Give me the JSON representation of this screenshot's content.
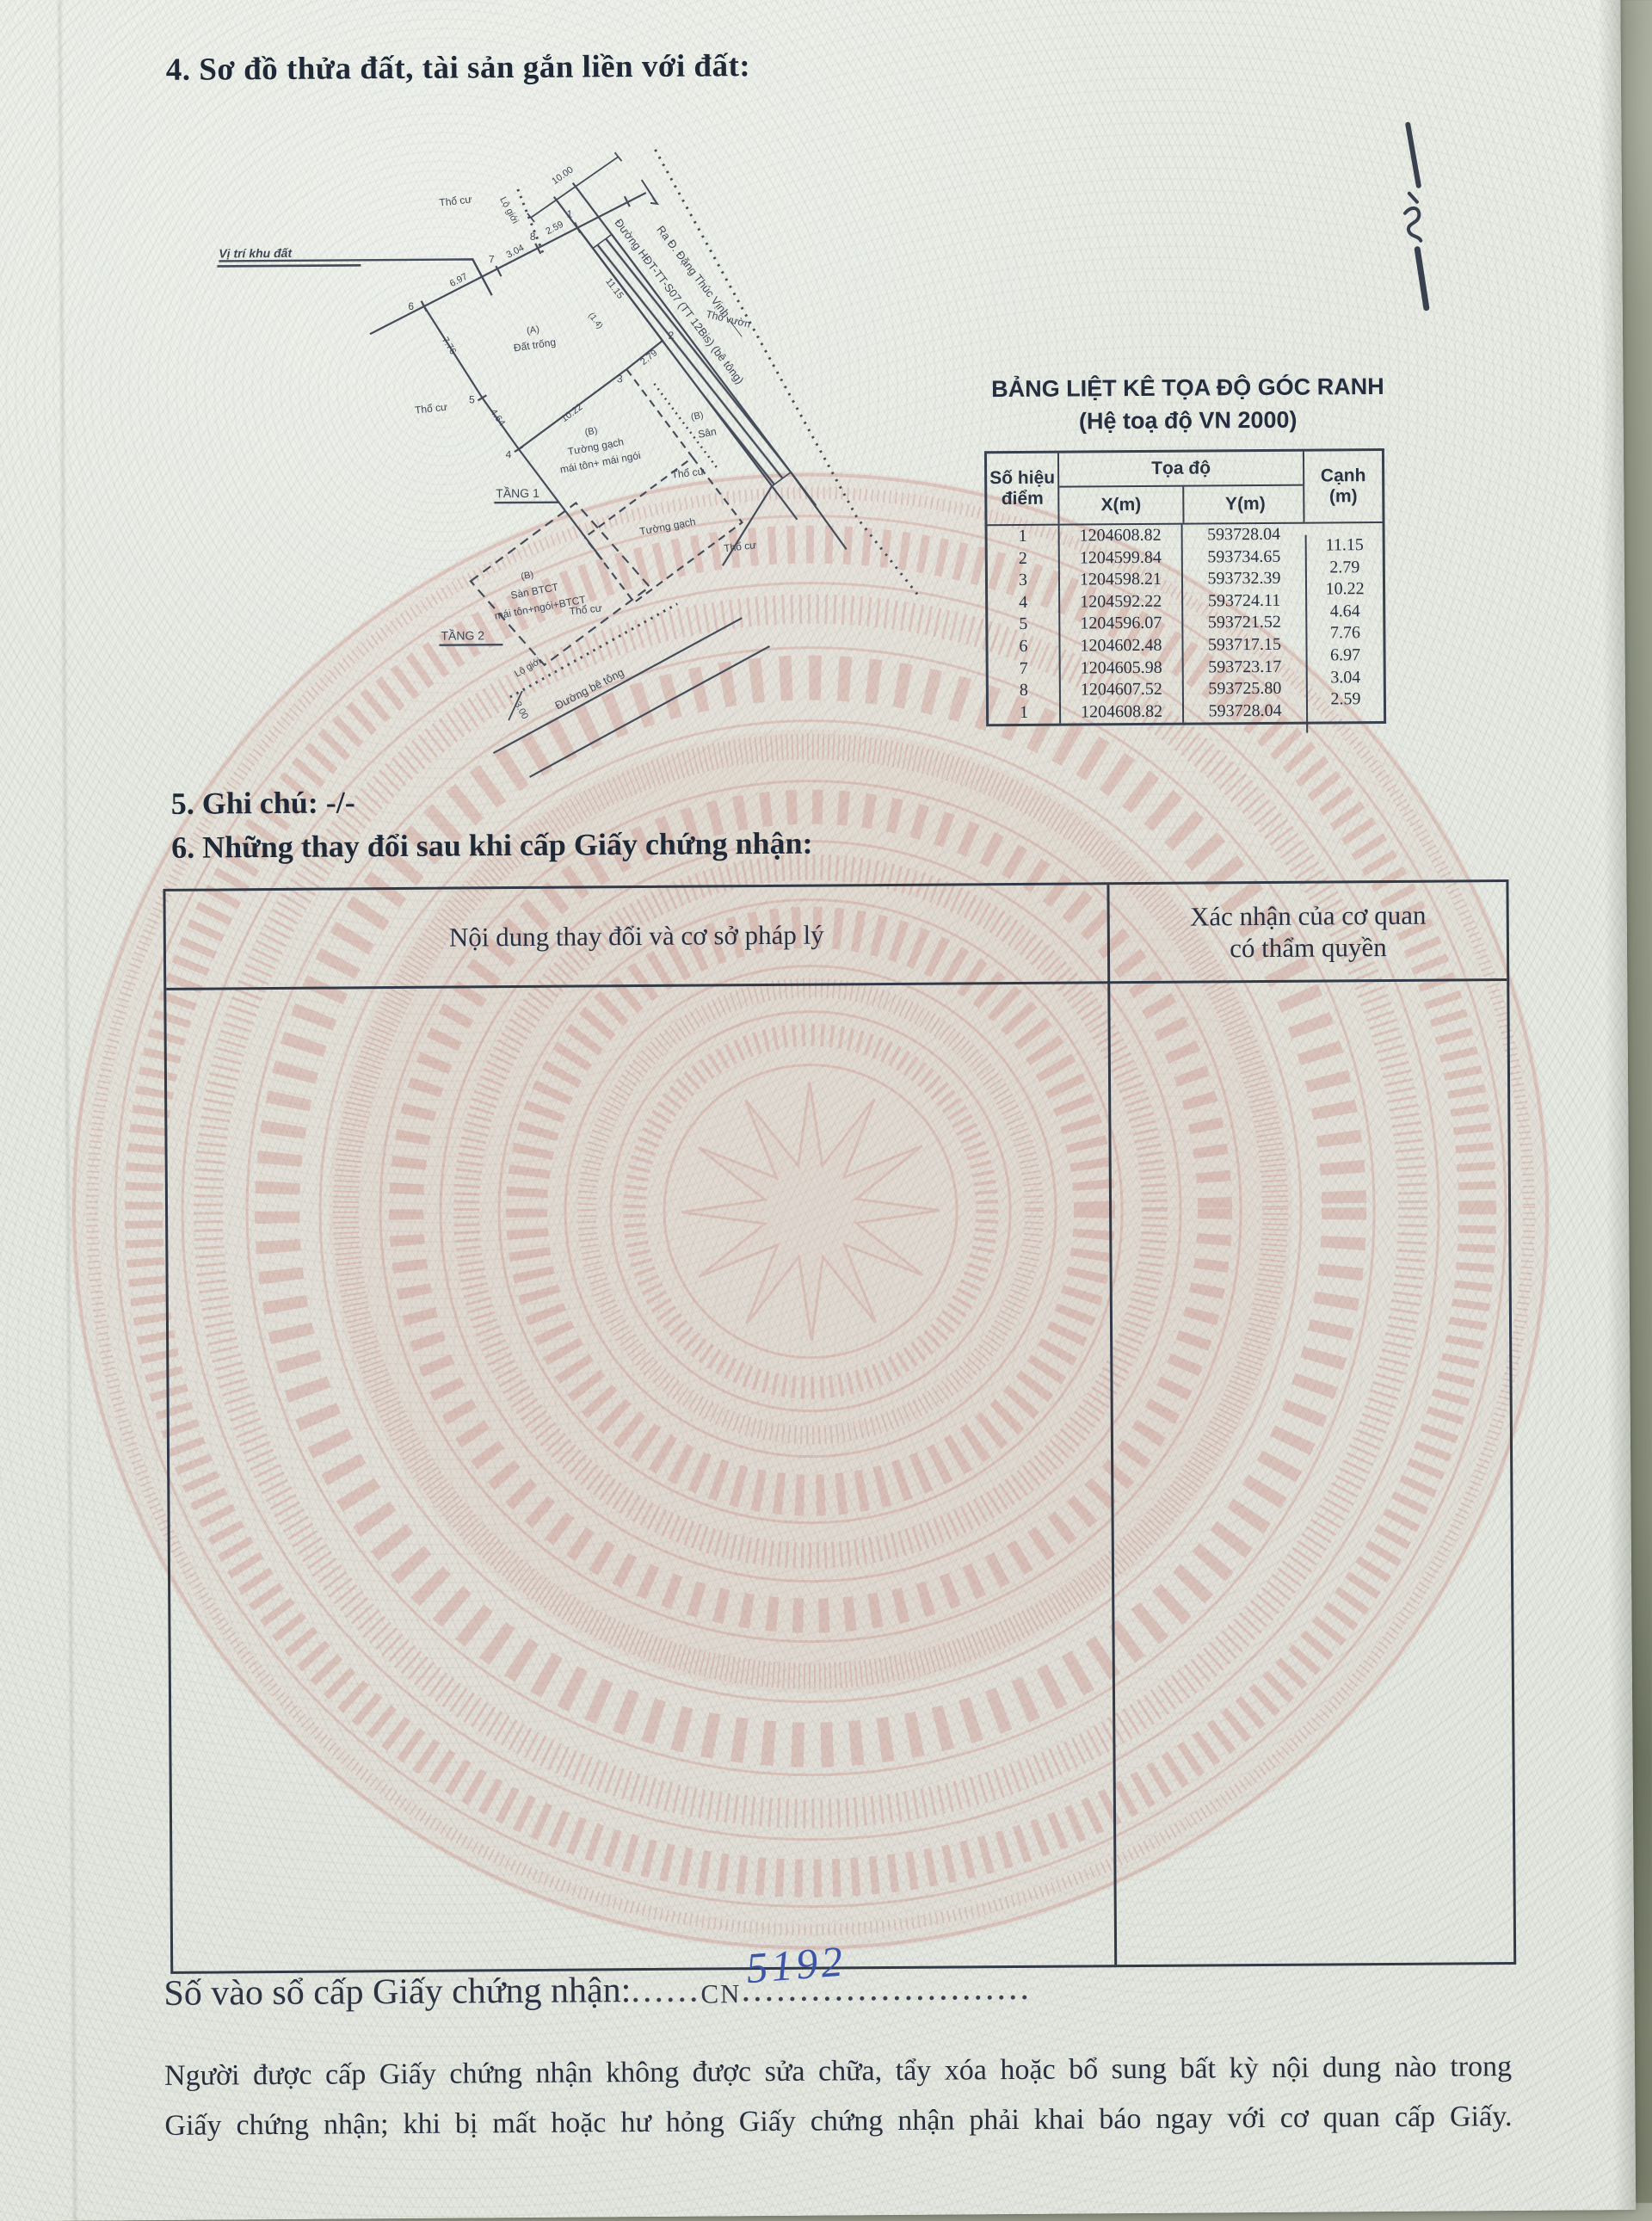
{
  "document": {
    "section4_title": "4. Sơ đồ thửa đất, tài sản gắn liền với đất:",
    "section5_title": "5. Ghi chú: -/-",
    "section6_title": "6. Những thay đổi sau khi cấp Giấy chứng nhận:",
    "registry": {
      "label": "Số vào sổ cấp Giấy chứng nhận:",
      "dots_leading": "......",
      "cn_prefix": "CN",
      "number": "5192",
      "dots_trailing": "........................."
    },
    "footer_line1": "Người được cấp Giấy chứng nhận không được sửa chữa, tẩy xóa hoặc bổ sung bất kỳ nội dung nào trong",
    "footer_line2": "Giấy chứng nhận; khi bị mất hoặc hư hỏng Giấy chứng nhận phải khai báo ngay với cơ quan cấp Giấy."
  },
  "coordinate_table": {
    "title_line1": "BẢNG LIỆT KÊ TỌA ĐỘ GÓC RANH",
    "title_line2": "(Hệ toạ độ VN 2000)",
    "header": {
      "point_no_1": "Số hiệu",
      "point_no_2": "điểm",
      "coords": "Tọa độ",
      "x": "X(m)",
      "y": "Y(m)",
      "edge_1": "Cạnh",
      "edge_2": "(m)"
    },
    "rows": [
      {
        "p": "1",
        "x": "1204608.82",
        "y": "593728.04",
        "e": "11.15"
      },
      {
        "p": "2",
        "x": "1204599.84",
        "y": "593734.65",
        "e": "2.79"
      },
      {
        "p": "3",
        "x": "1204598.21",
        "y": "593732.39",
        "e": "10.22"
      },
      {
        "p": "4",
        "x": "1204592.22",
        "y": "593724.11",
        "e": "4.64"
      },
      {
        "p": "5",
        "x": "1204596.07",
        "y": "593721.52",
        "e": "7.76"
      },
      {
        "p": "6",
        "x": "1204602.48",
        "y": "593717.15",
        "e": "6.97"
      },
      {
        "p": "7",
        "x": "1204605.98",
        "y": "593723.17",
        "e": "3.04"
      },
      {
        "p": "8",
        "x": "1204607.52",
        "y": "593725.80",
        "e": "2.59"
      },
      {
        "p": "1",
        "x": "1204608.82",
        "y": "593728.04",
        "e": ""
      }
    ]
  },
  "changes_table": {
    "col_content": "Nội dung thay đổi và cơ sở pháp lý",
    "col_confirm_1": "Xác nhận của cơ quan",
    "col_confirm_2": "có thẩm quyền"
  },
  "diagram": {
    "location_label": "Vị trí khu đất",
    "residential": "Thổ cư",
    "garden": "Thổ vườn",
    "road_boundary": "Lộ giới",
    "parcel_a": "(A)",
    "parcel_a_desc": "Đất trống",
    "parcel_b": "(B)",
    "wall1": "Tường gạch",
    "wall1_roof": "mái tôn+ mái ngói",
    "yard": "Sân",
    "wall2": "Tường gạch",
    "floor1": "TẦNG 1",
    "floor2": "TẦNG 2",
    "slab": "Sàn BTCT",
    "slab_roof": "mái tôn+ngói+BTCT",
    "road_direction": "Ra Đ. Đặng Thúc Vịnh ——",
    "road_name": "Đường HĐT-TT-S07 (TT 12Bis) (bê tông)",
    "road_concrete": "Đường bê tông",
    "dims": {
      "top": "10.00",
      "lane": "(1.4)",
      "e12": "11.15",
      "e23": "2.79",
      "e34": "10.22",
      "e45": "4.64",
      "e56": "7.76",
      "e67": "6.97",
      "e78": "3.04",
      "e81": "2.59",
      "setback": "3.00"
    },
    "points": {
      "p1": "1",
      "p2": "2",
      "p3": "3",
      "p4": "4",
      "p5": "5",
      "p6": "6",
      "p7": "7",
      "p8": "8"
    }
  }
}
